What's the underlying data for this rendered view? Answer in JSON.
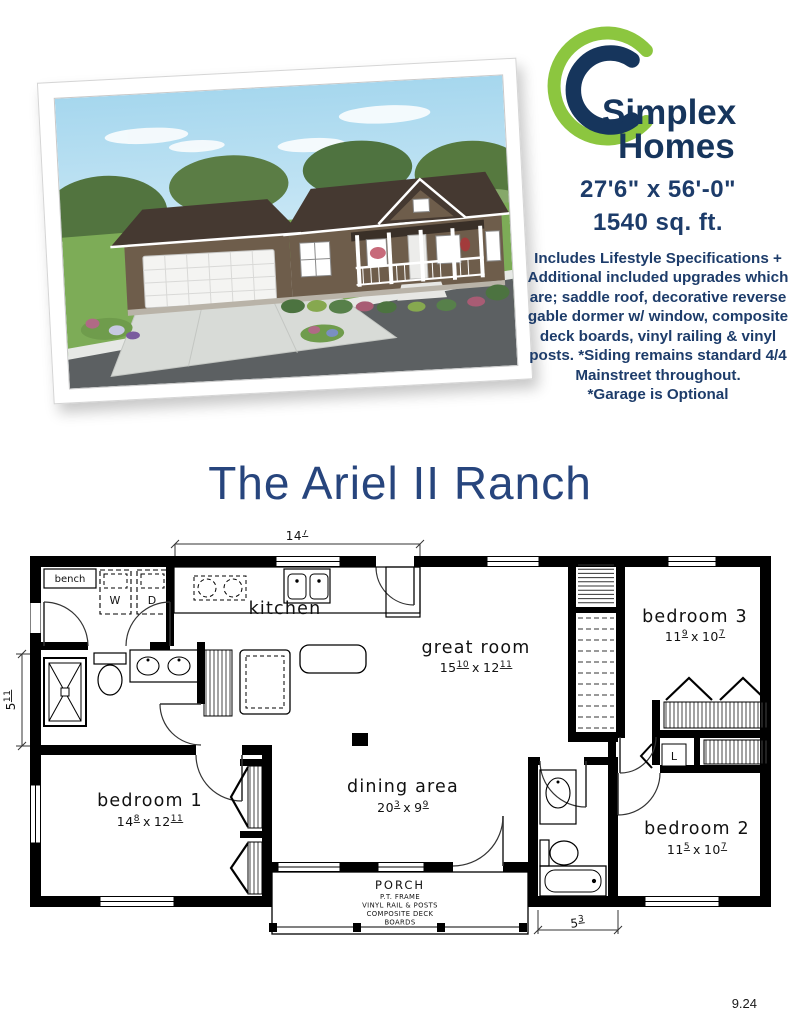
{
  "page": {
    "footer_code": "9.24"
  },
  "brand": {
    "name_line1": "Simplex",
    "name_line2": "Homes",
    "green": "#8cc63f",
    "navy": "#16355c"
  },
  "specs": {
    "dimensions": "27'6\" x 56'-0\"",
    "area": "1540 sq. ft.",
    "description": "Includes Lifestyle Specifications + Additional included upgrades which are; saddle roof, decorative reverse gable dormer w/ window, composite deck boards, vinyl railing & vinyl posts.  *Siding remains standard 4/4 Mainstreet throughout.",
    "garage_note": "*Garage is Optional"
  },
  "title": "The Ariel II Ranch",
  "floorplan": {
    "dims_separator": "x",
    "rooms": {
      "kitchen": {
        "label": "kitchen"
      },
      "great_room": {
        "label": "great room",
        "w_ft": "15",
        "w_in": "10",
        "h_ft": "12",
        "h_in": "11"
      },
      "bedroom3": {
        "label": "bedroom 3",
        "w_ft": "11",
        "w_in": "9",
        "h_ft": "10",
        "h_in": "7"
      },
      "bedroom1": {
        "label": "bedroom 1",
        "w_ft": "14",
        "w_in": "8",
        "h_ft": "12",
        "h_in": "11"
      },
      "dining": {
        "label": "dining area",
        "w_ft": "20",
        "w_in": "3",
        "h_ft": "9",
        "h_in": "9"
      },
      "bedroom2": {
        "label": "bedroom 2",
        "w_ft": "11",
        "w_in": "5",
        "h_ft": "10",
        "h_in": "7"
      }
    },
    "fixtures": {
      "bench": "bench",
      "washer": "W",
      "dryer": "D",
      "linen": "L"
    },
    "porch": {
      "title": "PORCH",
      "lines": [
        "P.T. FRAME",
        "VINYL RAIL & POSTS",
        "COMPOSITE DECK",
        "BOARDS"
      ]
    },
    "dimensions": {
      "kitchen_width": {
        "ft": "14",
        "in": "7"
      },
      "bath_depth": {
        "ft": "5",
        "in": "11"
      },
      "bath2_width": {
        "ft": "5",
        "in": "3"
      }
    }
  }
}
